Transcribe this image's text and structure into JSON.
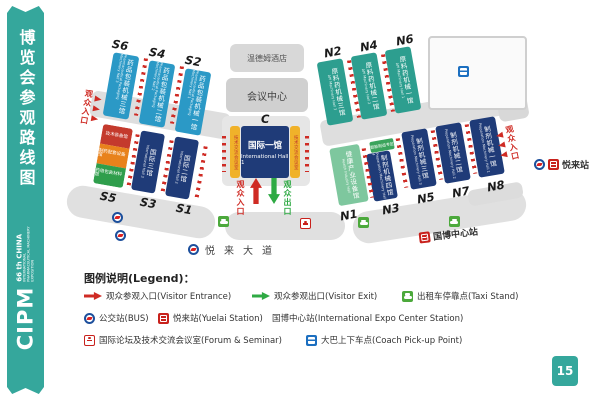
{
  "colors": {
    "accent_teal": "#35a79c",
    "hall_navy": "#1f3b78",
    "hall_blue": "#2b99c6",
    "hall_green": "#2d9e8f",
    "hall_lightgreen": "#7ec79e",
    "strip_yellow": "#f0b22a",
    "route_red": "#cf2b24",
    "exit_green": "#2faa44"
  },
  "sidebar": {
    "title": "博览会参观路线图",
    "brand": "CIPM",
    "brand_no": "66 th",
    "brand_country": "CHINA",
    "brand_sub": "INTERNATIONAL PHARMACEUTICAL MACHINERY EXPOSITION"
  },
  "page_number": "15",
  "map": {
    "labels": {
      "entrance": "观众入口",
      "exit": "观众出口",
      "hotel": "温德姆酒店",
      "conference": "会议中心",
      "road": "悦来大道",
      "expo_station": "国博中心站",
      "yuelai_station": "悦来站"
    },
    "halls": {
      "c": {
        "code": "C",
        "cn": "国际一馆",
        "en": "International Hall 1",
        "color": "#1f3b78"
      },
      "c_side": {
        "cn": "技术交流会议室",
        "color": "#f0b22a"
      },
      "s1": {
        "code": "S1",
        "cn": "国际二馆",
        "en": "International Hall 2",
        "color": "#1f3b78"
      },
      "s3": {
        "code": "S3",
        "cn": "国际三馆",
        "en": "International Hall 3",
        "color": "#1f3b78"
      },
      "s2": {
        "code": "S2",
        "cn": "药品包装机械一馆",
        "en": "Pharmaceutical Packaging Machinery Hall 1",
        "color": "#2b99c6"
      },
      "s4": {
        "code": "S4",
        "cn": "药品包装机械二馆",
        "en": "Pharmaceutical Packaging Machinery Hall 2",
        "color": "#2b99c6"
      },
      "s6": {
        "code": "S6",
        "cn": "药品包装机械三馆",
        "en": "Pharmaceutical Packaging Machinery Hall 3",
        "color": "#2b99c6"
      },
      "s5": {
        "code": "S5",
        "segments": [
          {
            "cn": "技术装备馆",
            "color": "#c43a2d"
          },
          {
            "cn": "制药配套设备馆",
            "color": "#e8821c"
          },
          {
            "cn": "药用包装材料馆",
            "color": "#2f9e4c"
          }
        ]
      },
      "n2": {
        "code": "N2",
        "cn": "原料药机械三馆",
        "en": "API Machinery Hall 3",
        "color": "#2d9e8f"
      },
      "n4": {
        "code": "N4",
        "cn": "原料药机械二馆",
        "en": "API Machinery Hall 2",
        "color": "#2d9e8f"
      },
      "n6": {
        "code": "N6",
        "cn": "原料药机械一馆",
        "en": "API Machinery Hall 1",
        "color": "#2d9e8f"
      },
      "n1": {
        "code": "N1",
        "cn": "健康产业设备馆",
        "en": "Health Industry Hall",
        "color": "#7ec79e"
      },
      "n3": {
        "code": "N3",
        "cn": "制剂机械四馆",
        "en": "Preparation Machinery Hall 4",
        "color": "#1f3b78",
        "banner": "智能制造专区"
      },
      "n5": {
        "code": "N5",
        "cn": "制剂机械三馆",
        "en": "Preparation Machinery Hall 3",
        "color": "#1f3b78"
      },
      "n7": {
        "code": "N7",
        "cn": "制剂机械二馆",
        "en": "Preparation Machinery Hall 2",
        "color": "#1f3b78"
      },
      "n8": {
        "code": "N8",
        "cn": "制剂机械一馆",
        "en": "Preparation Machinery Hall 1",
        "color": "#1f3b78"
      }
    }
  },
  "legend": {
    "title": "图例说明(Legend)：",
    "items": {
      "entrance": "观众参观入口(Visitor Entrance)",
      "exit": "观众参观出口(Visitor Exit)",
      "taxi": "出租车停靠点(Taxi Stand)",
      "bus": "公交站(BUS)",
      "yuelai": "悦来站(Yuelai Station)",
      "expo": "国博中心站(International Expo Center Station)",
      "forum": "国际论坛及技术交流会议室(Forum & Seminar)",
      "coach": "大巴上下车点(Coach Pick-up Point)"
    }
  }
}
